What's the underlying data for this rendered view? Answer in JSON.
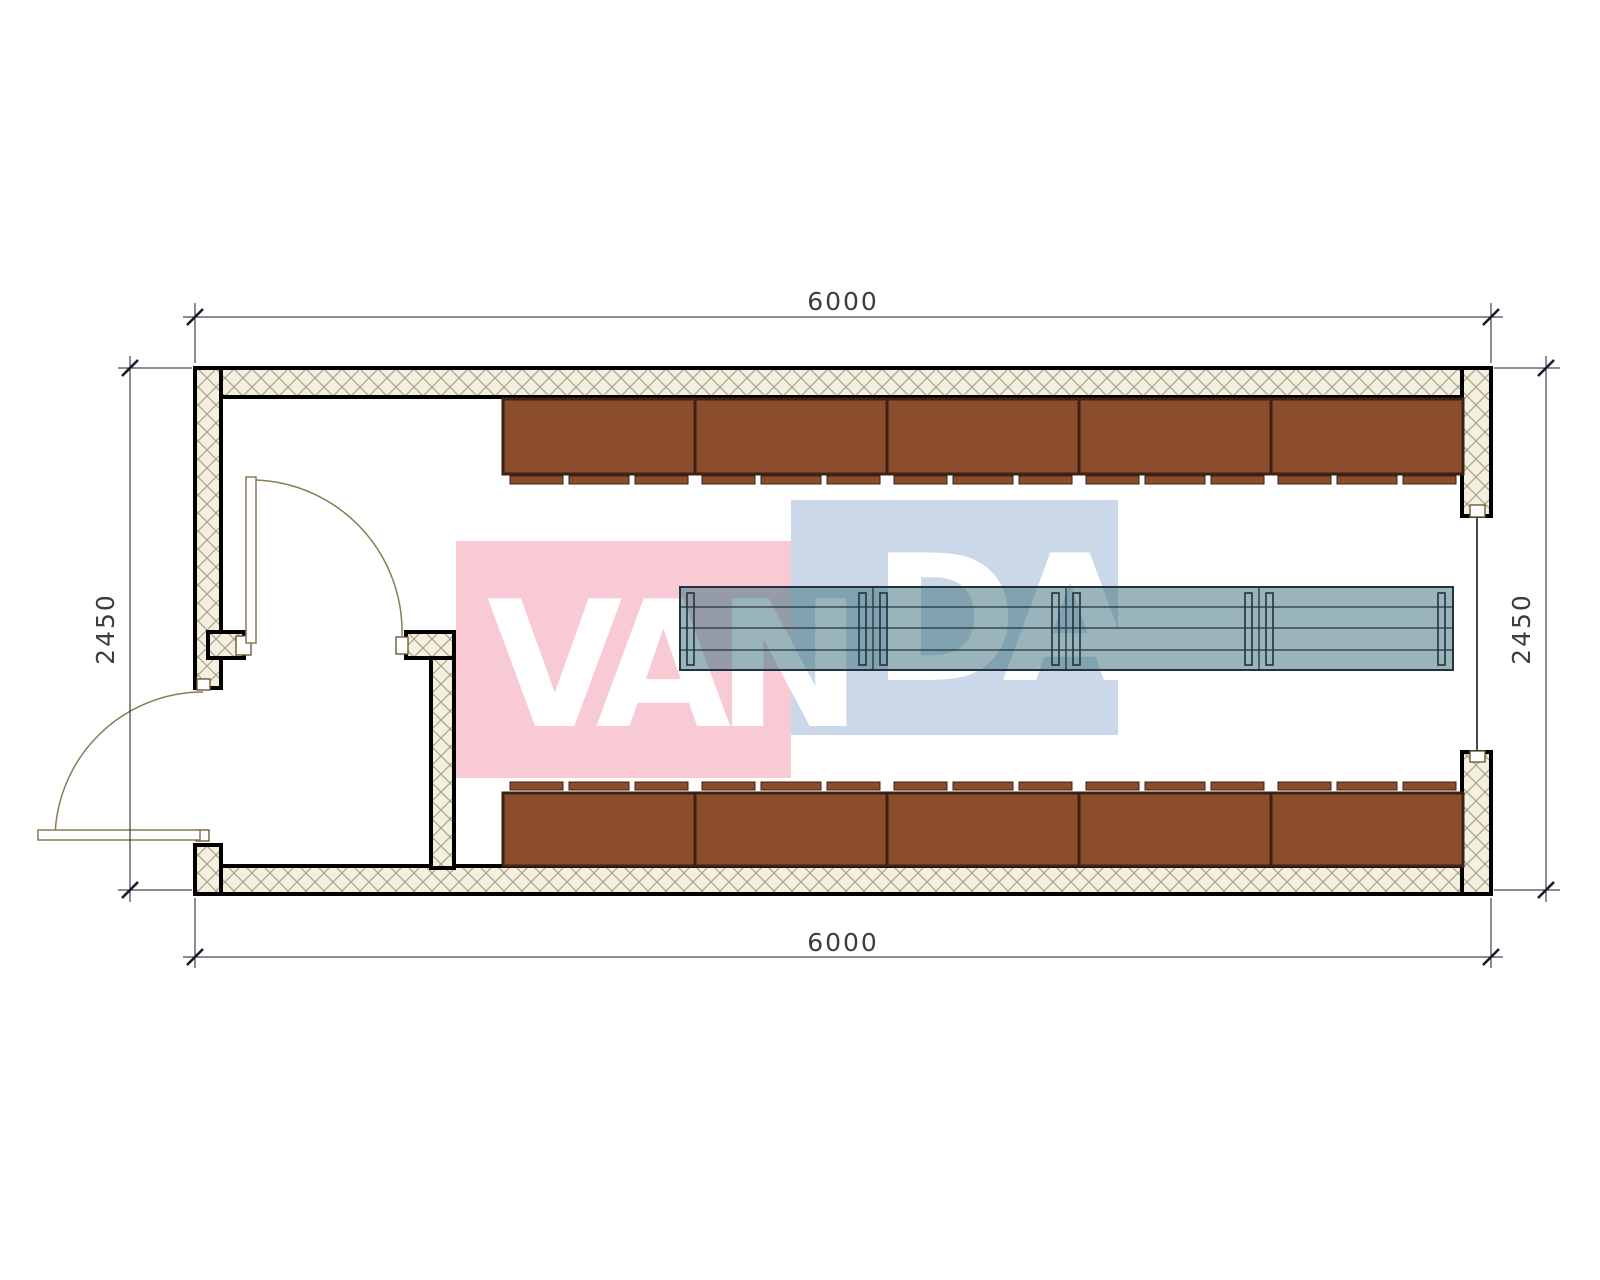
{
  "drawing": {
    "type": "floor-plan",
    "dimensions": {
      "top": "6000",
      "bottom": "6000",
      "left": "2450",
      "right": "2450",
      "units": "mm"
    },
    "watermark": {
      "text": "VANDA",
      "left_part": "VAN",
      "right_part": "DA",
      "pink_block": "#f8cad4",
      "blue_block": "#cad8ea",
      "text_color": "#ffffff"
    },
    "elements": {
      "cabinets_top_count": 5,
      "cabinets_bottom_count": 5,
      "table_sections": 4,
      "doors": 2,
      "right_wall_opening": 1
    },
    "colors": {
      "cabinet_fill": "#8c4d2d",
      "cabinet_border": "#3b2212",
      "wall_hatch_bg": "#f4f0e0",
      "wall_hatch_line": "#a89f85",
      "wall_outline": "#000000",
      "table_fill": "#457681",
      "table_outline": "#22333b",
      "door_arc": "#8a7a55",
      "dim_color": "#3d3d3d"
    }
  }
}
